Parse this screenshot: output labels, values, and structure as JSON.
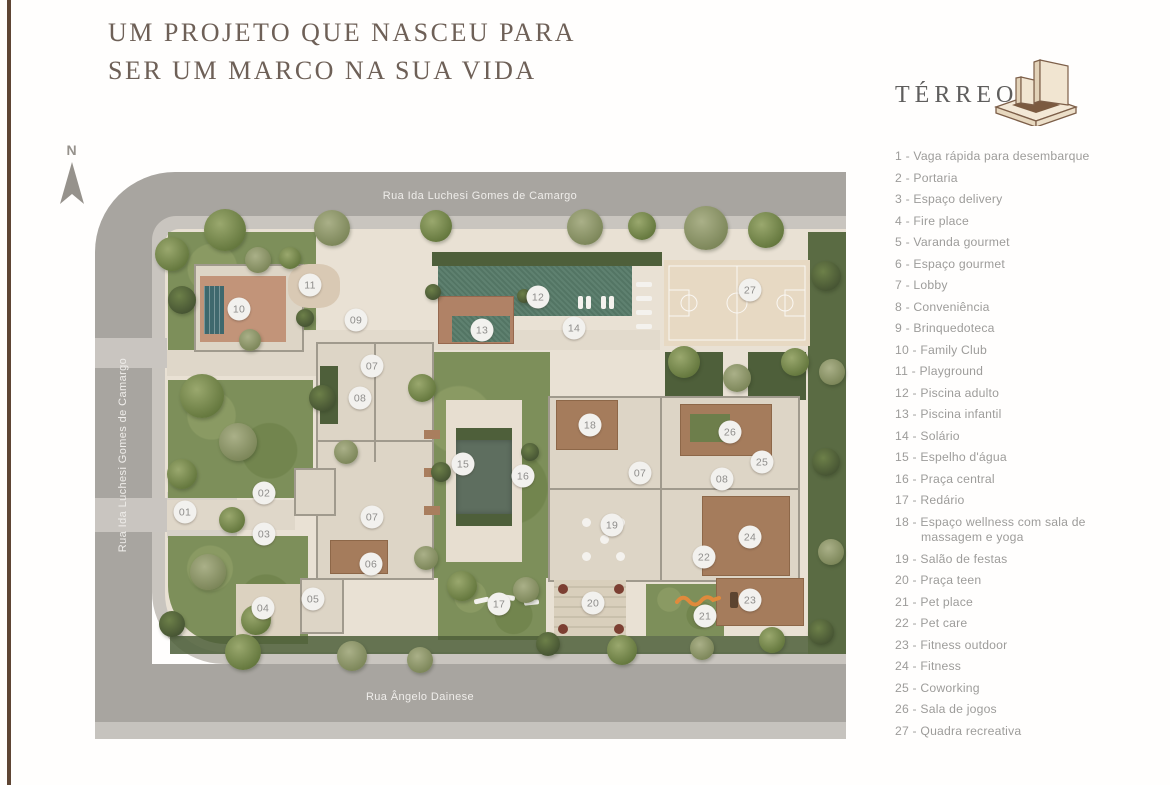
{
  "page": {
    "title_line1": "UM PROJETO QUE NASCEU PARA",
    "title_line2": "SER UM MARCO NA SUA VIDA"
  },
  "panel": {
    "floor_label": "TÉRREO",
    "building_icon": "isometric-building-icon",
    "legend": [
      {
        "num": "1",
        "label": "Vaga rápida para desembarque"
      },
      {
        "num": "2",
        "label": "Portaria"
      },
      {
        "num": "3",
        "label": "Espaço delivery"
      },
      {
        "num": "4",
        "label": "Fire place"
      },
      {
        "num": "5",
        "label": "Varanda gourmet"
      },
      {
        "num": "6",
        "label": "Espaço gourmet"
      },
      {
        "num": "7",
        "label": "Lobby"
      },
      {
        "num": "8",
        "label": "Conveniência"
      },
      {
        "num": "9",
        "label": "Brinquedoteca"
      },
      {
        "num": "10",
        "label": "Family Club"
      },
      {
        "num": "11",
        "label": "Playground"
      },
      {
        "num": "12",
        "label": "Piscina adulto"
      },
      {
        "num": "13",
        "label": "Piscina infantil"
      },
      {
        "num": "14",
        "label": "Solário"
      },
      {
        "num": "15",
        "label": "Espelho d'água"
      },
      {
        "num": "16",
        "label": "Praça central"
      },
      {
        "num": "17",
        "label": "Redário"
      },
      {
        "num": "18",
        "label": "Espaço wellness com sala de massagem e yoga"
      },
      {
        "num": "19",
        "label": "Salão de festas"
      },
      {
        "num": "20",
        "label": "Praça teen"
      },
      {
        "num": "21",
        "label": "Pet place"
      },
      {
        "num": "22",
        "label": "Pet care"
      },
      {
        "num": "23",
        "label": "Fitness outdoor"
      },
      {
        "num": "24",
        "label": "Fitness"
      },
      {
        "num": "25",
        "label": "Coworking"
      },
      {
        "num": "26",
        "label": "Sala de jogos"
      },
      {
        "num": "27",
        "label": "Quadra recreativa"
      }
    ]
  },
  "plan": {
    "north_label": "N",
    "streets": {
      "top": "Rua Ida Luchesi Gomes de Camargo",
      "left": "Rua Ida Luchesi Gomes de Camargo",
      "bottom": "Rua Ângelo Dainese"
    },
    "markers": [
      {
        "num": "01",
        "x": 185,
        "y": 512
      },
      {
        "num": "02",
        "x": 264,
        "y": 493
      },
      {
        "num": "03",
        "x": 264,
        "y": 534
      },
      {
        "num": "04",
        "x": 263,
        "y": 608
      },
      {
        "num": "05",
        "x": 313,
        "y": 599
      },
      {
        "num": "06",
        "x": 371,
        "y": 564
      },
      {
        "num": "07",
        "x": 372,
        "y": 366
      },
      {
        "num": "07",
        "x": 372,
        "y": 517
      },
      {
        "num": "07",
        "x": 640,
        "y": 473
      },
      {
        "num": "08",
        "x": 360,
        "y": 398
      },
      {
        "num": "08",
        "x": 722,
        "y": 479
      },
      {
        "num": "09",
        "x": 356,
        "y": 320
      },
      {
        "num": "10",
        "x": 239,
        "y": 309
      },
      {
        "num": "11",
        "x": 310,
        "y": 285
      },
      {
        "num": "12",
        "x": 538,
        "y": 297
      },
      {
        "num": "13",
        "x": 482,
        "y": 330
      },
      {
        "num": "14",
        "x": 574,
        "y": 328
      },
      {
        "num": "15",
        "x": 463,
        "y": 464
      },
      {
        "num": "16",
        "x": 523,
        "y": 476
      },
      {
        "num": "17",
        "x": 499,
        "y": 604
      },
      {
        "num": "18",
        "x": 590,
        "y": 425
      },
      {
        "num": "19",
        "x": 612,
        "y": 525
      },
      {
        "num": "20",
        "x": 593,
        "y": 603
      },
      {
        "num": "21",
        "x": 705,
        "y": 616
      },
      {
        "num": "22",
        "x": 704,
        "y": 557
      },
      {
        "num": "23",
        "x": 750,
        "y": 600
      },
      {
        "num": "24",
        "x": 750,
        "y": 537
      },
      {
        "num": "25",
        "x": 762,
        "y": 462
      },
      {
        "num": "26",
        "x": 730,
        "y": 432
      },
      {
        "num": "27",
        "x": 750,
        "y": 290
      }
    ]
  },
  "colors": {
    "road": "#a8a5a0",
    "sidewalk": "#c9c5bf",
    "hardscape": "#e9e1d4",
    "lawn": "#7d8f5a",
    "hedge": "#4e5f3a",
    "pool": "#567a68",
    "wood_deck": "#a57c5c",
    "building": "#ddd5c6",
    "marker_bg": "#f2f1ee",
    "marker_text": "#8e8d8b",
    "title_text": "#6e6057",
    "legend_text": "#9d9c9a",
    "accent_orange": "#e08a3c",
    "edge_strip": "#5e4534"
  }
}
